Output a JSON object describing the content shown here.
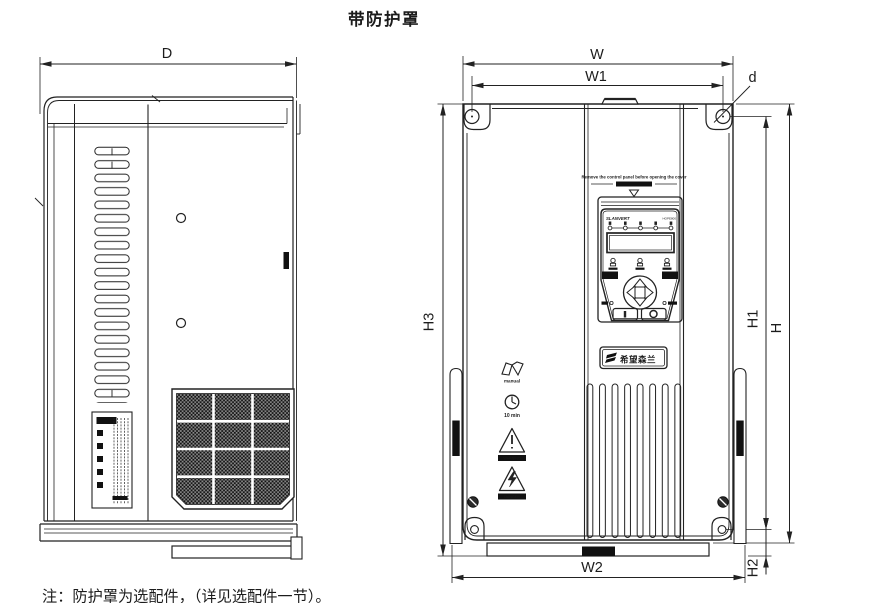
{
  "title": "带防护罩",
  "footnote": "注：防护罩为选配件，（详见选配件一节）。",
  "dims": {
    "D": "D",
    "W": "W",
    "W1": "W1",
    "W2": "W2",
    "H": "H",
    "H1": "H1",
    "H2": "H2",
    "H3": "H3",
    "d": "d"
  },
  "panel": {
    "warning_en": "Remove the control panel before opening the cover",
    "brand": "SLANVERT",
    "model": "HOPE800",
    "logo_cn": "希望森兰"
  },
  "captions": {
    "manual": "manual",
    "timer": "10 min",
    "warning": "WARNING",
    "danger": "DANGER"
  },
  "colors": {
    "line": "#222222",
    "background": "#ffffff",
    "dark_fill": "#111111"
  }
}
